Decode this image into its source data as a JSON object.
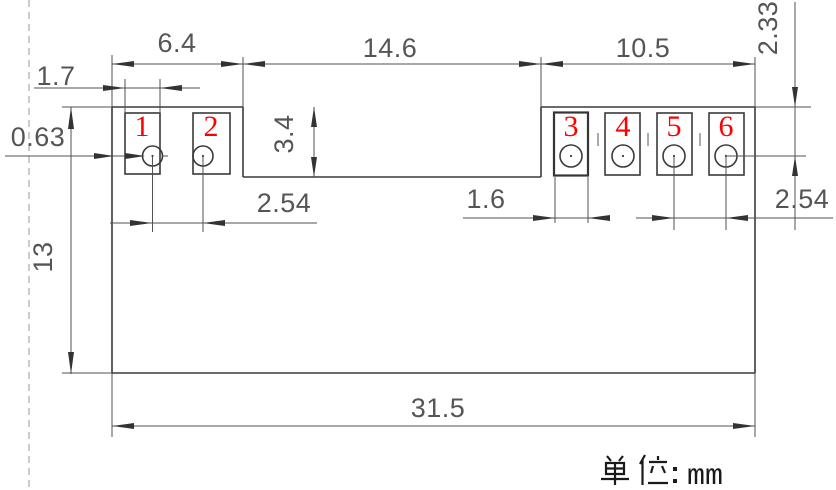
{
  "drawing": {
    "type": "mechanical-dimension-drawing",
    "line_color": "#3a3a3a",
    "dim_color": "#555555",
    "pad_number_color": "#ff0000",
    "pads": [
      {
        "number": "1"
      },
      {
        "number": "2"
      },
      {
        "number": "3"
      },
      {
        "number": "4"
      },
      {
        "number": "5"
      },
      {
        "number": "6"
      }
    ],
    "dimensions": {
      "left_section_width": "6.4",
      "middle_section_width": "14.6",
      "right_section_width": "10.5",
      "left_pad_width": "1.7",
      "edge_to_pad_gap": "0.63",
      "step_depth": "3.4",
      "hole_pitch_left": "2.54",
      "right_pad_width": "1.6",
      "hole_pitch_right": "2.54",
      "top_to_hole_center": "2.33",
      "overall_height": "13",
      "overall_width": "31.5"
    },
    "footer": {
      "unit_label": "单位：mm",
      "unit_prefix": "单位：",
      "unit_value": "mm"
    }
  }
}
